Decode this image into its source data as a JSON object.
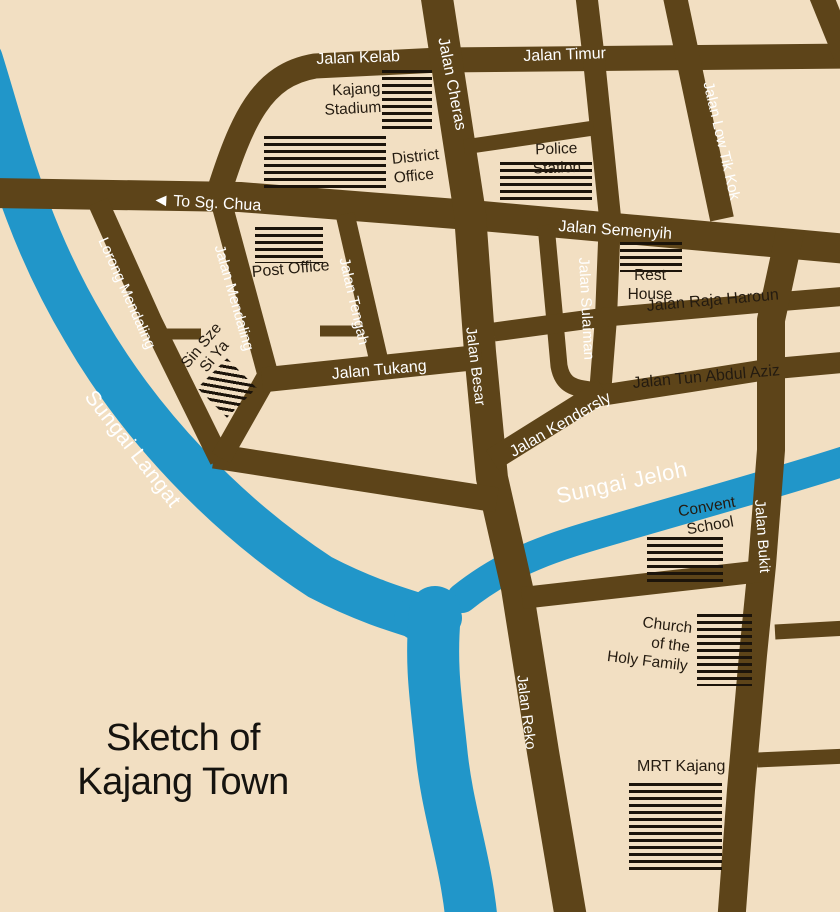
{
  "title": {
    "line1": "Sketch of",
    "line2": "Kajang Town"
  },
  "direction_sign": {
    "arrow": "◀",
    "label": "To Sg. Chua"
  },
  "colors": {
    "background": "#f2dfc2",
    "road": "#5d4419",
    "river": "#2196c9",
    "building_hatch": "#1c140a",
    "road_label": "#ffffff",
    "dark_label": "#241b10"
  },
  "rivers": {
    "langat": "Sungai Langat",
    "jeloh": "Sungai Jeloh"
  },
  "roads": {
    "kelab": "Jalan Kelab",
    "timur": "Jalan Timur",
    "cheras": "Jalan Cheras",
    "low_tik_kok": "Jalan Low Tik Kok",
    "semenyih": "Jalan Semenyih",
    "lorong_mendaling": "Lorong Mendaling",
    "mendaling": "Jalan Mendaling",
    "tengah": "Jalan Tengah",
    "tukang": "Jalan Tukang",
    "besar": "Jalan Besar",
    "sulaiman": "Jalan Sulaiman",
    "raja_haroun": "Jalan Raja Haroun",
    "tun_abdul_aziz": "Jalan Tun Abdul Aziz",
    "kendersly": "Jalan Kendersly",
    "bukit": "Jalan Bukit",
    "reko": "Jalan Reko"
  },
  "places": {
    "stadium": {
      "lines": [
        "Kajang",
        "Stadium"
      ]
    },
    "district": {
      "lines": [
        "District",
        "Office"
      ]
    },
    "police": {
      "lines": [
        "Police",
        "Station"
      ]
    },
    "post": {
      "label": "Post Office"
    },
    "sin_sze": {
      "lines": [
        "Sin Sze",
        "Si Ya"
      ]
    },
    "rest": {
      "lines": [
        "Rest",
        "House"
      ]
    },
    "convent": {
      "lines": [
        "Convent",
        "School"
      ]
    },
    "church": {
      "lines": [
        "Church",
        "of the",
        "Holy Family"
      ]
    },
    "mrt": {
      "label": "MRT Kajang"
    }
  }
}
